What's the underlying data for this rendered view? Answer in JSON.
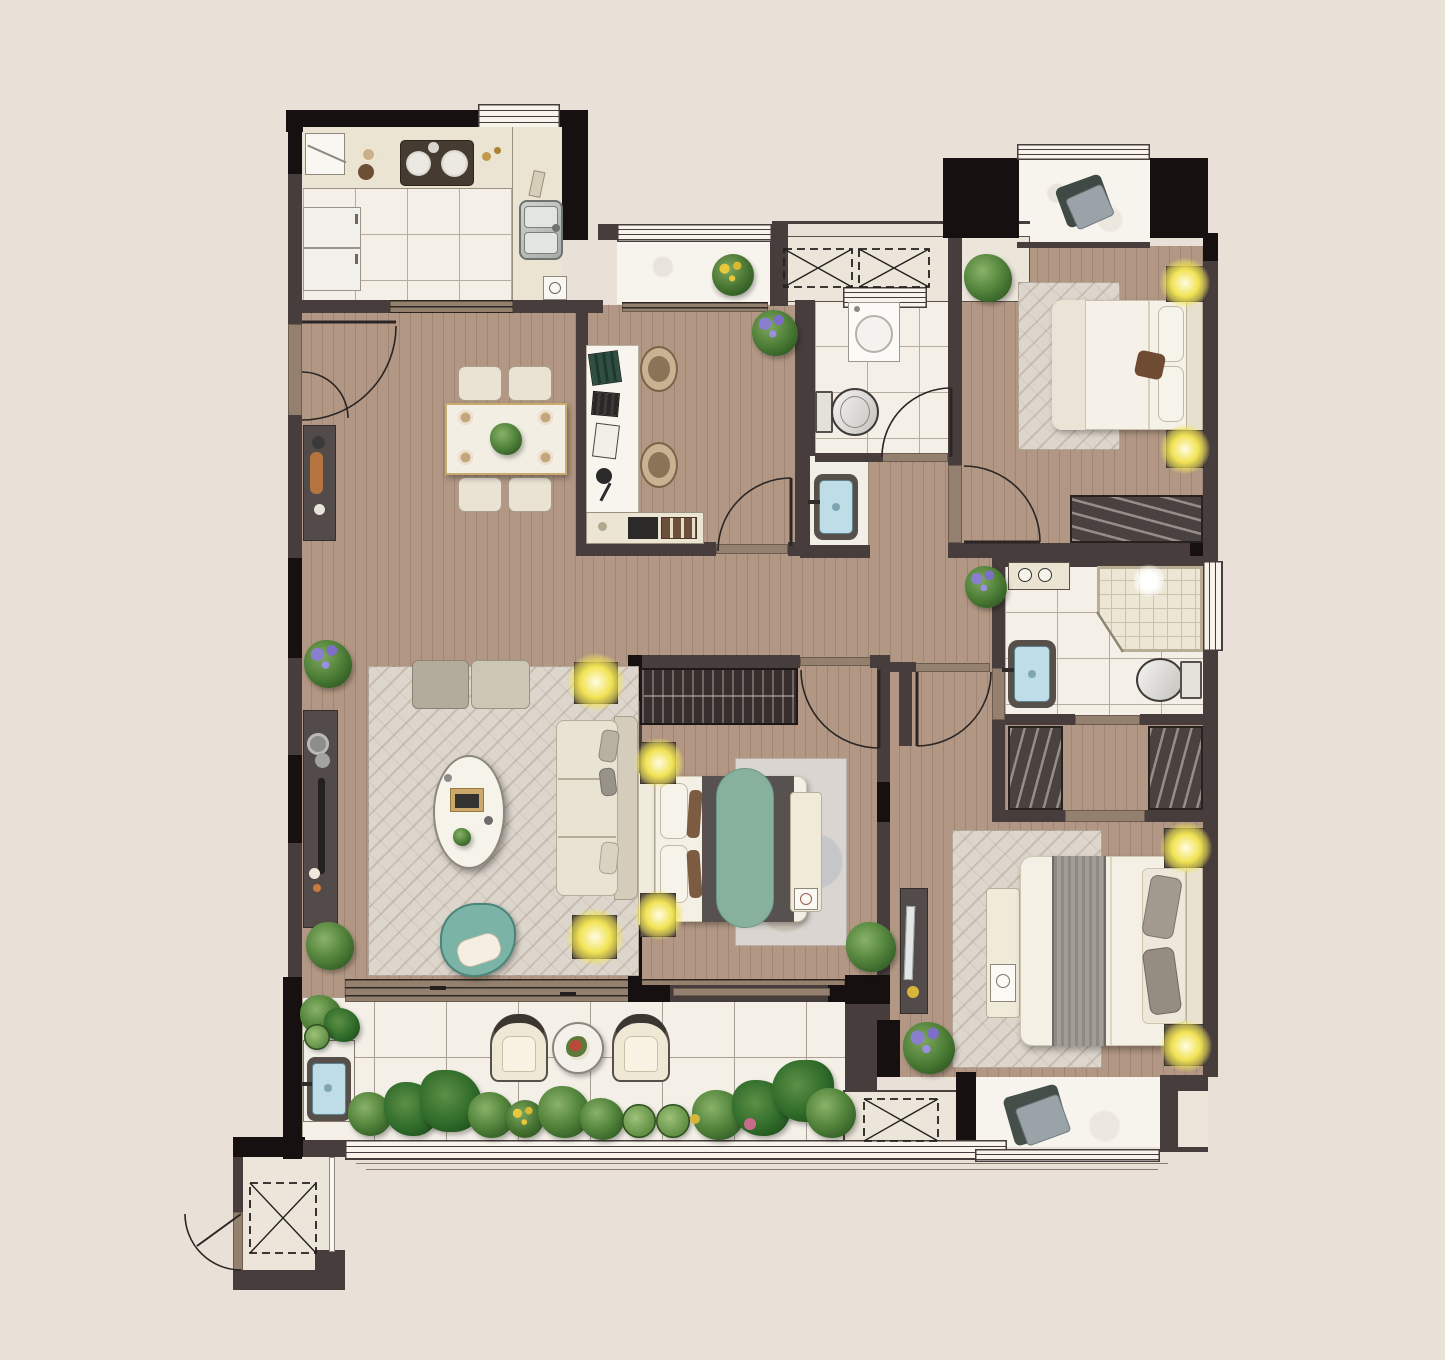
{
  "meta": {
    "kind": "residential-floor-plan",
    "view": "top-down-rendered",
    "visible_text": "none"
  },
  "palette": {
    "bg": "#e9e1d7",
    "wall": "#473d3c",
    "wallBlack": "#161110",
    "wood": "#b29884",
    "tile": "#f4f0e8",
    "tileLine": "#b7ac9d",
    "marble": "#f7f4ed",
    "counter": "#ebe4d2",
    "thresh": "#93806f",
    "rug": "#dcd6cd",
    "darkFurn": "#524b49",
    "teal": "#7cb3a7",
    "greenBed": "#87b19d",
    "lampYellow": "#f1e354",
    "lampBase": "#5d5345",
    "plantGreen": "#55863d",
    "flowerPurple": "#8a7ece",
    "basinBlue": "#bedde6",
    "gold": "#c9ab6e",
    "line": "#2b2524",
    "white": "#f5f1e8"
  },
  "rooms": [
    {
      "id": "kitchen",
      "items": [
        "counter",
        "cooktop",
        "double-sink",
        "refrigerator",
        "upper-cabinet",
        "floor-drain",
        "window",
        "sliding-door"
      ]
    },
    {
      "id": "dining-area",
      "items": [
        "dining-table",
        "dining-chair",
        "dining-chair",
        "dining-chair",
        "dining-chair",
        "shoe-cabinet",
        "entry-double-door"
      ]
    },
    {
      "id": "living-room",
      "items": [
        "sofa",
        "ottoman-bench",
        "coffee-table",
        "media-console",
        "accent-chair",
        "area-rug",
        "floor-lamp",
        "floor-lamp",
        "potted-plant",
        "potted-plant",
        "balcony-sliding-door"
      ]
    },
    {
      "id": "study",
      "items": [
        "desk",
        "desk-chair",
        "desk-chair",
        "low-cabinet",
        "small-balcony",
        "potted-plant",
        "door"
      ]
    },
    {
      "id": "common-bathroom",
      "items": [
        "washing-machine",
        "toilet",
        "washbasin-niche",
        "window",
        "door"
      ]
    },
    {
      "id": "bedroom-top-right",
      "items": [
        "double-bed",
        "wardrobe",
        "nightstand-lamp",
        "nightstand-lamp",
        "area-rug",
        "bay-window",
        "potted-plant",
        "door"
      ]
    },
    {
      "id": "bedroom-middle",
      "items": [
        "double-bed",
        "bookshelf",
        "foot-bench",
        "nightstand-lamp",
        "nightstand-lamp",
        "area-rug",
        "potted-plant",
        "door"
      ]
    },
    {
      "id": "master-bedroom",
      "items": [
        "double-bed",
        "foot-bench",
        "media-console",
        "nightstand-lamp",
        "nightstand-lamp",
        "area-rug",
        "bay-window",
        "potted-plant"
      ]
    },
    {
      "id": "master-bathroom",
      "items": [
        "corner-shower",
        "toilet",
        "washbasin",
        "vanity-counter",
        "window"
      ]
    },
    {
      "id": "walk-in-closet",
      "items": [
        "wardrobe",
        "wardrobe"
      ]
    },
    {
      "id": "balcony",
      "items": [
        "lounge-chair",
        "lounge-chair",
        "round-side-table",
        "washbasin",
        "planter-bed",
        "railing-window"
      ]
    },
    {
      "id": "service",
      "items": [
        "ac-platform-top",
        "ac-platform-bottom",
        "elevator-shaft",
        "corridor",
        "hallway"
      ]
    }
  ]
}
